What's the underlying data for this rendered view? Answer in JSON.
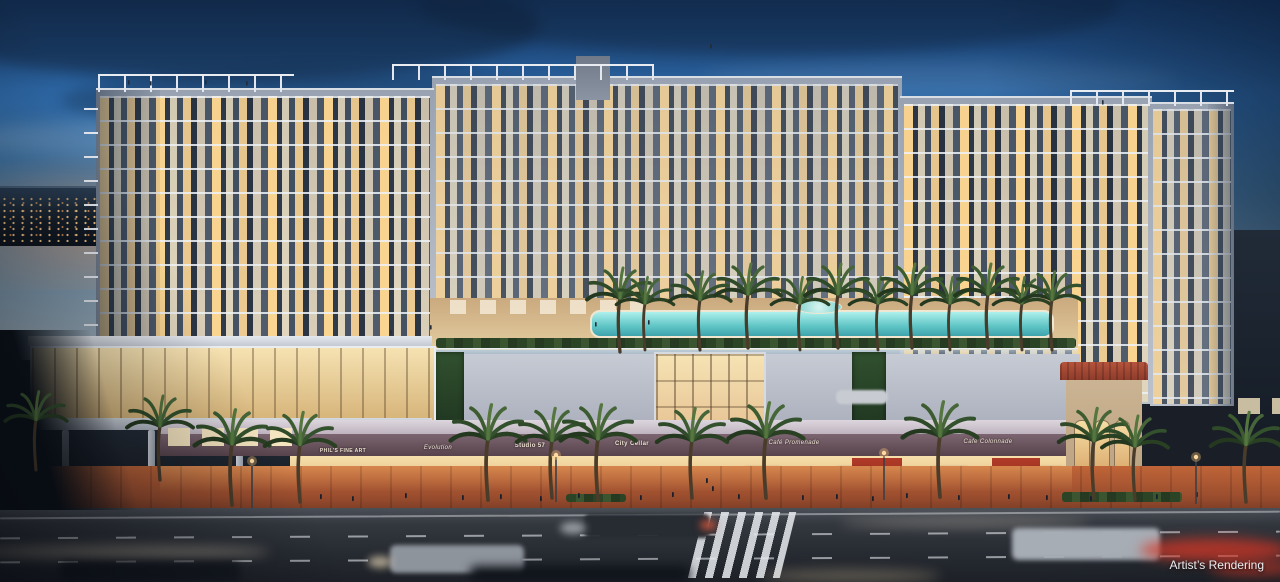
{
  "scene": {
    "caption": "Artist’s Rendering",
    "subject": "Dusk rendering of a mixed-use residential building with rooftop pool deck, café terraces and street-level retail"
  },
  "signs": {
    "retail": [
      {
        "label": "PHIL'S FINE ART"
      },
      {
        "label": "Evolution"
      },
      {
        "label": "Studio 57"
      },
      {
        "label": "City Cellar"
      },
      {
        "label": "Café Promenade"
      },
      {
        "label": "Café Colonnade"
      }
    ]
  },
  "palette": {
    "sky_top": "#1c4a84",
    "sky_horizon": "#a3b0ba",
    "dusk_glow": "#e19664",
    "facade": "#aab2bf",
    "window_glow": "#ffd68c",
    "pool_water": "#5ec4c4",
    "awning_blue": "#1d4a92",
    "sidewalk_brick": "#b85c38",
    "asphalt": "#2b2f36",
    "taillight_red": "#d93a28"
  }
}
